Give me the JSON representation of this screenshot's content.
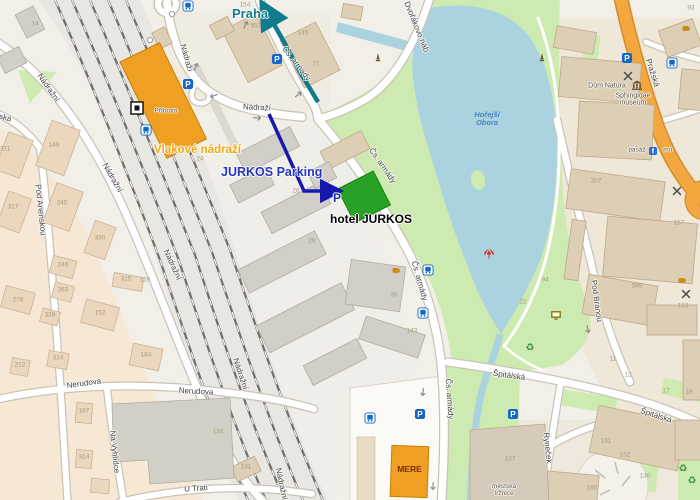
{
  "colors": {
    "arrow_teal": "#0f7c8e",
    "arrow_navy": "#1718ad",
    "station_orange": "#efa023",
    "hotel_green": "#28a226",
    "mere_orange": "#efa023",
    "water_blue": "#aad3df",
    "park_green": "#cdebb0",
    "main_road_orange": "#f4a73f"
  },
  "annotations": {
    "praha": {
      "text": "Praha"
    },
    "jurkos_parking": {
      "text": "JURKOS Parking"
    },
    "parking_p": {
      "text": "P"
    },
    "hotel": {
      "text": "hotel JURKOS"
    },
    "station": {
      "text": "Vlakové nádraží"
    },
    "mere": {
      "text": "MERE"
    }
  },
  "street_labels": [
    {
      "text": "Nádražní",
      "x": 48,
      "y": 88,
      "rot": 55
    },
    {
      "text": "Nádražní",
      "x": 112,
      "y": 178,
      "rot": 60
    },
    {
      "text": "Nádražní",
      "x": 172,
      "y": 265,
      "rot": 65
    },
    {
      "text": "Nádražní",
      "x": 240,
      "y": 374,
      "rot": 72
    },
    {
      "text": "Nádražní",
      "x": 281,
      "y": 484,
      "rot": 78
    },
    {
      "text": "Anenská",
      "x": -4,
      "y": 116,
      "rot": 14
    },
    {
      "text": "Pod Anenskou",
      "x": 40,
      "y": 210,
      "rot": 84
    },
    {
      "text": "Nerudova",
      "x": 84,
      "y": 384,
      "rot": -8
    },
    {
      "text": "Nerudova",
      "x": 196,
      "y": 392,
      "rot": 3
    },
    {
      "text": "Na Vyhlídce",
      "x": 114,
      "y": 452,
      "rot": 84
    },
    {
      "text": "U Trati",
      "x": 196,
      "y": 489,
      "rot": -4
    },
    {
      "text": "Nádraží",
      "x": 186,
      "y": 58,
      "rot": 74
    },
    {
      "text": "Nádraží",
      "x": 257,
      "y": 108,
      "rot": 3
    },
    {
      "text": "Čs. armády",
      "x": 296,
      "y": 64,
      "rot": 52
    },
    {
      "text": "Čs. armády",
      "x": 382,
      "y": 166,
      "rot": 55
    },
    {
      "text": "Čs. armády",
      "x": 419,
      "y": 281,
      "rot": 74
    },
    {
      "text": "Čs. armády",
      "x": 449,
      "y": 399,
      "rot": 86
    },
    {
      "text": "Dvořákovo náb",
      "x": 416,
      "y": 27,
      "rot": 68
    },
    {
      "text": "Pražská",
      "x": 652,
      "y": 73,
      "rot": 72
    },
    {
      "text": "Pod Branou",
      "x": 596,
      "y": 301,
      "rot": 82
    },
    {
      "text": "Špitálská",
      "x": 509,
      "y": 376,
      "rot": 8
    },
    {
      "text": "Špitálská",
      "x": 656,
      "y": 416,
      "rot": 18
    },
    {
      "text": "Ryneček",
      "x": 547,
      "y": 448,
      "rot": 84
    }
  ],
  "poi_labels": [
    {
      "text": "Příbram",
      "x": 166,
      "y": 112,
      "size": 6.5
    },
    {
      "text": "Dům Natura",
      "x": 607,
      "y": 86
    },
    {
      "text": "Sphingidae\nmuseum",
      "x": 633,
      "y": 100
    },
    {
      "text": "Hořejší\nObora",
      "x": 487,
      "y": 119,
      "kind": "water"
    },
    {
      "text": "pasáž",
      "x": 637,
      "y": 151,
      "size": 6.5
    },
    {
      "text": "mír",
      "x": 668,
      "y": 151,
      "size": 6.5
    },
    {
      "text": "městská\ntržnice",
      "x": 504,
      "y": 491,
      "size": 6.5
    }
  ],
  "house_numbers": [
    {
      "text": "14",
      "x": 35,
      "y": 25
    },
    {
      "text": "321",
      "x": 5,
      "y": 150
    },
    {
      "text": "149",
      "x": 54,
      "y": 146
    },
    {
      "text": "317",
      "x": 13,
      "y": 208
    },
    {
      "text": "245",
      "x": 62,
      "y": 204
    },
    {
      "text": "330",
      "x": 100,
      "y": 239
    },
    {
      "text": "278",
      "x": 18,
      "y": 301
    },
    {
      "text": "246",
      "x": 63,
      "y": 266
    },
    {
      "text": "363",
      "x": 63,
      "y": 291
    },
    {
      "text": "338",
      "x": 50,
      "y": 316
    },
    {
      "text": "152",
      "x": 100,
      "y": 314
    },
    {
      "text": "315",
      "x": 126,
      "y": 280
    },
    {
      "text": "119",
      "x": 145,
      "y": 281
    },
    {
      "text": "212",
      "x": 20,
      "y": 366
    },
    {
      "text": "314",
      "x": 58,
      "y": 359
    },
    {
      "text": "184",
      "x": 146,
      "y": 356
    },
    {
      "text": "187",
      "x": 84,
      "y": 412
    },
    {
      "text": "314",
      "x": 84,
      "y": 458
    },
    {
      "text": "134",
      "x": 218,
      "y": 433
    },
    {
      "text": "131",
      "x": 246,
      "y": 468
    },
    {
      "text": "154",
      "x": 245,
      "y": 6
    },
    {
      "text": "553",
      "x": 256,
      "y": 27
    },
    {
      "text": "145",
      "x": 303,
      "y": 34
    },
    {
      "text": "72",
      "x": 316,
      "y": 65
    },
    {
      "text": "93",
      "x": 691,
      "y": 9
    },
    {
      "text": "26",
      "x": 296,
      "y": 192
    },
    {
      "text": "28",
      "x": 312,
      "y": 242
    },
    {
      "text": "24",
      "x": 200,
      "y": 160
    },
    {
      "text": "30",
      "x": 394,
      "y": 296
    },
    {
      "text": "143",
      "x": 412,
      "y": 332
    },
    {
      "text": "22",
      "x": 523,
      "y": 303
    },
    {
      "text": "94",
      "x": 545,
      "y": 281
    },
    {
      "text": "207",
      "x": 596,
      "y": 182
    },
    {
      "text": "157",
      "x": 679,
      "y": 224
    },
    {
      "text": "589",
      "x": 637,
      "y": 287
    },
    {
      "text": "153",
      "x": 683,
      "y": 307
    },
    {
      "text": "11",
      "x": 613,
      "y": 360
    },
    {
      "text": "12",
      "x": 628,
      "y": 376
    },
    {
      "text": "131",
      "x": 606,
      "y": 442
    },
    {
      "text": "132",
      "x": 625,
      "y": 456
    },
    {
      "text": "130",
      "x": 645,
      "y": 477
    },
    {
      "text": "160",
      "x": 592,
      "y": 489
    },
    {
      "text": "137",
      "x": 510,
      "y": 460
    },
    {
      "text": "17",
      "x": 666,
      "y": 392
    },
    {
      "text": "18",
      "x": 689,
      "y": 393
    }
  ],
  "icons": [
    {
      "type": "parking",
      "x": 188,
      "y": 84
    },
    {
      "type": "parking",
      "x": 277,
      "y": 59
    },
    {
      "type": "parking",
      "x": 627,
      "y": 58
    },
    {
      "type": "parking",
      "x": 420,
      "y": 414
    },
    {
      "type": "parking",
      "x": 513,
      "y": 414
    },
    {
      "type": "bus",
      "x": 188,
      "y": 6
    },
    {
      "type": "bus",
      "x": 146,
      "y": 130
    },
    {
      "type": "bus",
      "x": 428,
      "y": 270
    },
    {
      "type": "bus",
      "x": 423,
      "y": 313
    },
    {
      "type": "bus",
      "x": 370,
      "y": 418
    },
    {
      "type": "bus",
      "x": 672,
      "y": 63
    },
    {
      "type": "restaurant",
      "x": 628,
      "y": 76
    },
    {
      "type": "restaurant",
      "x": 677,
      "y": 191
    },
    {
      "type": "restaurant",
      "x": 686,
      "y": 294
    },
    {
      "type": "cafe",
      "x": 397,
      "y": 270
    },
    {
      "type": "cafe",
      "x": 683,
      "y": 280
    },
    {
      "type": "cafe",
      "x": 687,
      "y": 28
    },
    {
      "type": "museum",
      "x": 637,
      "y": 85
    },
    {
      "type": "monitor",
      "x": 556,
      "y": 315
    },
    {
      "type": "recycle",
      "x": 530,
      "y": 347
    },
    {
      "type": "recycle",
      "x": 683,
      "y": 468
    },
    {
      "type": "recycle",
      "x": 692,
      "y": 480
    },
    {
      "type": "monument",
      "x": 378,
      "y": 57
    },
    {
      "type": "monument",
      "x": 542,
      "y": 57
    },
    {
      "type": "picnic",
      "x": 489,
      "y": 254
    },
    {
      "type": "station-sign",
      "x": 137,
      "y": 108
    },
    {
      "type": "passage",
      "x": 653,
      "y": 151
    },
    {
      "type": "dot",
      "x": 172,
      "y": 14
    },
    {
      "type": "dot",
      "x": 150,
      "y": 40
    }
  ],
  "oneway_arrows": [
    {
      "x": 196,
      "y": 66,
      "rot": -70
    },
    {
      "x": 213,
      "y": 96,
      "rot": 160
    },
    {
      "x": 258,
      "y": 118,
      "rot": 4
    },
    {
      "x": 299,
      "y": 94,
      "rot": -38
    },
    {
      "x": 246,
      "y": 24,
      "rot": -62
    },
    {
      "x": 423,
      "y": 393,
      "rot": 95
    },
    {
      "x": 433,
      "y": 487,
      "rot": 92
    },
    {
      "x": 588,
      "y": 330,
      "rot": 78
    }
  ]
}
